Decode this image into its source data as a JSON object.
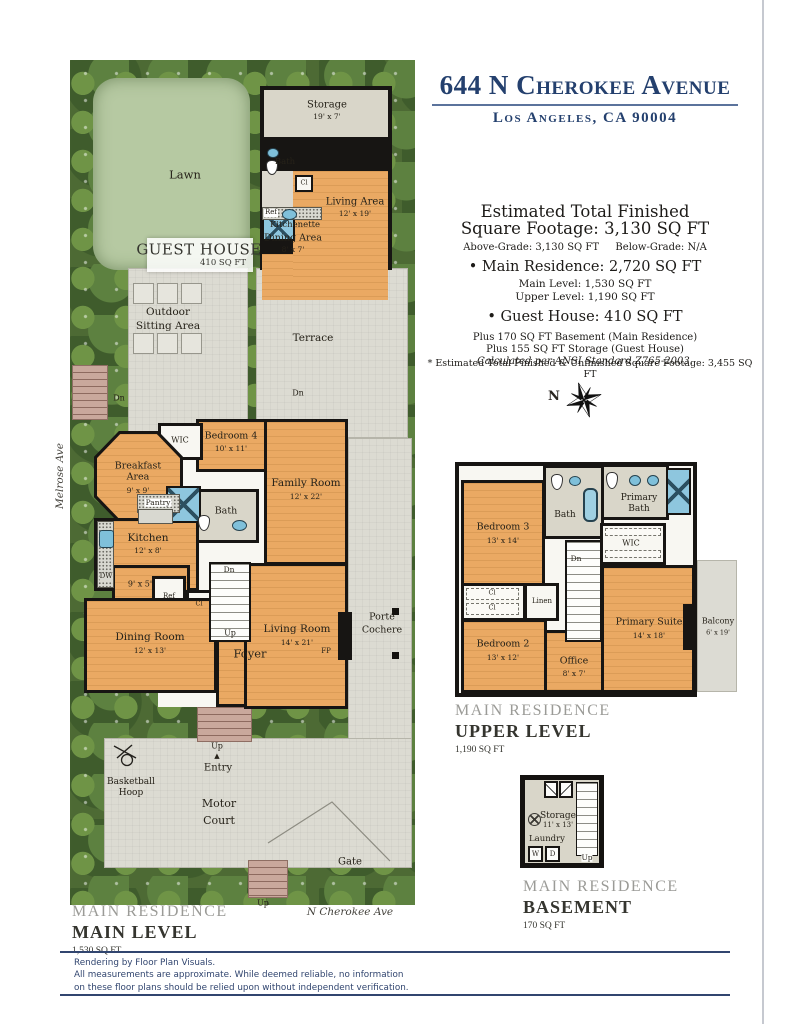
{
  "colors": {
    "navy": "#24406e",
    "floor_wood": "#eaa963",
    "floor_gray": "#d9d6c9",
    "paving": "#dcdbd2",
    "lawn": "#b6c9a2",
    "greenery": "#4d6a34",
    "wall": "#171513",
    "fixture_blue": "#8ec6de",
    "steps_brick": "#c9a89c",
    "section_gray": "#9b9b97",
    "section_dark": "#35352f"
  },
  "header": {
    "title": "644 N Cherokee Avenue",
    "city": "Los Angeles, CA 90004"
  },
  "summary": {
    "h1": "Estimated Total Finished",
    "h2": "Square Footage: 3,130 SQ FT",
    "above": "Above-Grade: 3,130 SQ FT",
    "below": "Below-Grade: N/A",
    "bullet_main": "• Main Residence: 2,720 SQ FT",
    "main_level": "Main Level: 1,530 SQ FT",
    "upper_level": "Upper Level: 1,190 SQ FT",
    "bullet_guest": "• Guest House: 410 SQ FT",
    "plus_basement": "Plus 170 SQ FT Basement (Main Residence)",
    "plus_storage": "Plus 155 SQ FT Storage (Guest House)",
    "ansi": "Calculated per ANSI Standard Z765-2003.",
    "footnote": "* Estimated Total Finished & Unfinished Square Footage: 3,455 SQ FT"
  },
  "compass": {
    "north": "N"
  },
  "site": {
    "melrose": "Melrose Ave",
    "cherokee": "N Cherokee Ave",
    "lawn": "Lawn",
    "outdoor": [
      "Outdoor",
      "Sitting Area"
    ],
    "terrace": "Terrace",
    "motor": [
      "Motor",
      "Court"
    ],
    "basketball": [
      "Basketball",
      "Hoop"
    ],
    "gate": "Gate",
    "entry": "Entry",
    "entry_marker": "▲",
    "up": "Up",
    "dn": "Dn"
  },
  "guest_house": {
    "title": "GUEST HOUSE",
    "sqft": "410 SQ FT",
    "storage": {
      "name": "Storage",
      "dims": "19' x 7'"
    },
    "bath": "Bath",
    "cl": "Cl",
    "living": {
      "name": "Living Area",
      "dims": "12' x 19'"
    },
    "ref": "Ref",
    "kitchenette": "Kitchenette",
    "dining": {
      "name": "Dining Area",
      "dims": "8' x 7'"
    }
  },
  "main_level": {
    "breakfast": {
      "name": "Breakfast Area",
      "dims": "9' x 9'"
    },
    "wic": "WIC",
    "bedroom4": {
      "name": "Bedroom 4",
      "dims": "10' x 11'"
    },
    "family": {
      "name": "Family Room",
      "dims": "12' x 22'"
    },
    "pantry": "Pantry",
    "bath": "Bath",
    "kitchen": {
      "name": "Kitchen",
      "dims": "12' x 8'"
    },
    "nook": "9' x 5'",
    "ref": "Ref",
    "dw": "DW",
    "cl": "Cl",
    "dining": {
      "name": "Dining Room",
      "dims": "12' x 13'"
    },
    "foyer": "Foyer",
    "living": {
      "name": "Living Room",
      "dims": "14' x 21'"
    },
    "fp": "FP",
    "up": "Up",
    "dn": "Dn",
    "porte": [
      "Porté",
      "Cochere"
    ]
  },
  "upper_level": {
    "bedroom3": {
      "name": "Bedroom 3",
      "dims": "13' x 14'"
    },
    "bath": "Bath",
    "primary_bath": [
      "Primary",
      "Bath"
    ],
    "wic": "WIC",
    "dn": "Dn",
    "linen": "Linen",
    "cl": "Cl",
    "bedroom2": {
      "name": "Bedroom 2",
      "dims": "13' x 12'"
    },
    "office": {
      "name": "Office",
      "dims": "8' x 7'"
    },
    "suite": {
      "name": "Primary Suite",
      "dims": "14' x 18'"
    },
    "balcony": {
      "name": "Balcony",
      "dims": "6' x 19'"
    }
  },
  "basement": {
    "storage": {
      "name": "Storage",
      "dims": "11' x 13'"
    },
    "laundry": "Laundry",
    "washer": "W",
    "dryer": "D",
    "up": "Up"
  },
  "sections": {
    "main": {
      "eyebrow": "MAIN RESIDENCE",
      "title": "MAIN LEVEL",
      "sqft": "1,530 SQ FT"
    },
    "upper": {
      "eyebrow": "MAIN RESIDENCE",
      "title": "UPPER LEVEL",
      "sqft": "1,190 SQ FT"
    },
    "basement": {
      "eyebrow": "MAIN RESIDENCE",
      "title": "BASEMENT",
      "sqft": "170 SQ FT"
    }
  },
  "footer": {
    "line1": "Rendering by Floor Plan Visuals.",
    "line2": "All measurements are approximate. While deemed reliable, no information",
    "line3": "on these floor plans should be relied upon without independent verification."
  }
}
